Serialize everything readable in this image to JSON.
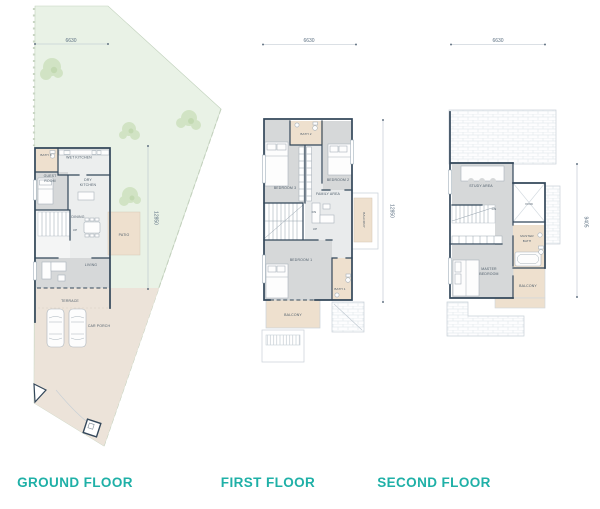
{
  "colors": {
    "accent": "#1fb0a7",
    "wall": "#33475a",
    "lot_green": "#e9f2e6",
    "paving_beige": "#ece3d9",
    "room_beige": "#eee0ce",
    "room_gray": "#d6d8d9",
    "dimension": "#5c7082"
  },
  "floors": {
    "ground": {
      "label": "GROUND FLOOR",
      "dim_width": "6630",
      "dim_depth": "12850",
      "rooms": {
        "bath3": "BATH 3",
        "wet_kitchen": "WET KITCHEN",
        "guest_room": [
          "GUEST",
          "ROOM"
        ],
        "dry_kitchen": [
          "DRY",
          "KITCHEN"
        ],
        "dining": "DINING",
        "up": "UP",
        "patio": "PATIO",
        "living": "LIVING",
        "terrace": "TERRACE",
        "car_porch": "CAR PORCH"
      }
    },
    "first": {
      "label": "FIRST FLOOR",
      "dim_width": "6630",
      "dim_depth": "12850",
      "rooms": {
        "bath2": "BATH 2",
        "bedroom3": "BEDROOM 3",
        "bedroom2": "BEDROOM 2",
        "family_area": "FAMILY AREA",
        "dn": "DN",
        "up": "UP",
        "bedroom1": "BEDROOM 1",
        "bath1": "BATH 1",
        "balcony": "BALCONY",
        "balcony_side": "BALCONY"
      }
    },
    "second": {
      "label": "SECOND FLOOR",
      "dim_width": "6630",
      "dim_depth": "9405",
      "rooms": {
        "study_area": "STUDY AREA",
        "dn": "DN",
        "void": "VOID",
        "master_bath": [
          "MASTER",
          "BATH"
        ],
        "master_bedroom": [
          "MASTER",
          "BEDROOM"
        ],
        "balcony": "BALCONY"
      }
    }
  }
}
